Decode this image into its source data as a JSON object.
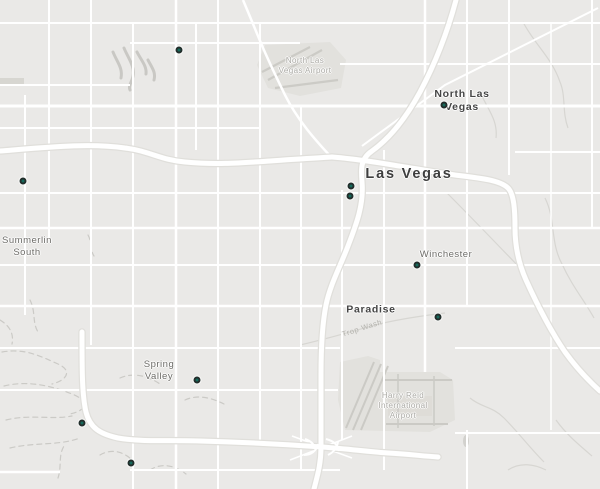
{
  "map": {
    "colors": {
      "background": "#eae9e7",
      "road": "#ffffff",
      "road_casing": "#e0dfdb",
      "terrain_wash": "#cbcac6",
      "airport_fill": "#e2e1dd",
      "airport_detail": "#cccbc6",
      "marker_fill": "#16695b",
      "marker_ring": "#222e2b",
      "city_label": "#3e3e3e",
      "town_label": "#6d6c68",
      "poi_label": "#adaca7"
    },
    "labels": {
      "las_vegas": {
        "text": "Las Vegas"
      },
      "north_las_vegas": {
        "line1": "North Las",
        "line2": "Vegas"
      },
      "north_las_vegas_airport": {
        "line1": "North Las",
        "line2": "Vegas Airport"
      },
      "summerlin_south": {
        "line1": "Summerlin",
        "line2": "South"
      },
      "winchester": {
        "text": "Winchester"
      },
      "paradise": {
        "text": "Paradise"
      },
      "trop_wash": {
        "text": "Trop Wash"
      },
      "spring_valley": {
        "line1": "Spring",
        "line2": "Valley"
      },
      "harry_reid_airport": {
        "line1": "Harry Reid",
        "line2": "International",
        "line3": "Airport"
      }
    },
    "markers": [
      {
        "x": 179,
        "y": 50
      },
      {
        "x": 444,
        "y": 105
      },
      {
        "x": 23,
        "y": 181
      },
      {
        "x": 351,
        "y": 186
      },
      {
        "x": 350,
        "y": 196
      },
      {
        "x": 417,
        "y": 265
      },
      {
        "x": 438,
        "y": 317
      },
      {
        "x": 197,
        "y": 380
      },
      {
        "x": 82,
        "y": 423
      },
      {
        "x": 131,
        "y": 463
      }
    ]
  }
}
